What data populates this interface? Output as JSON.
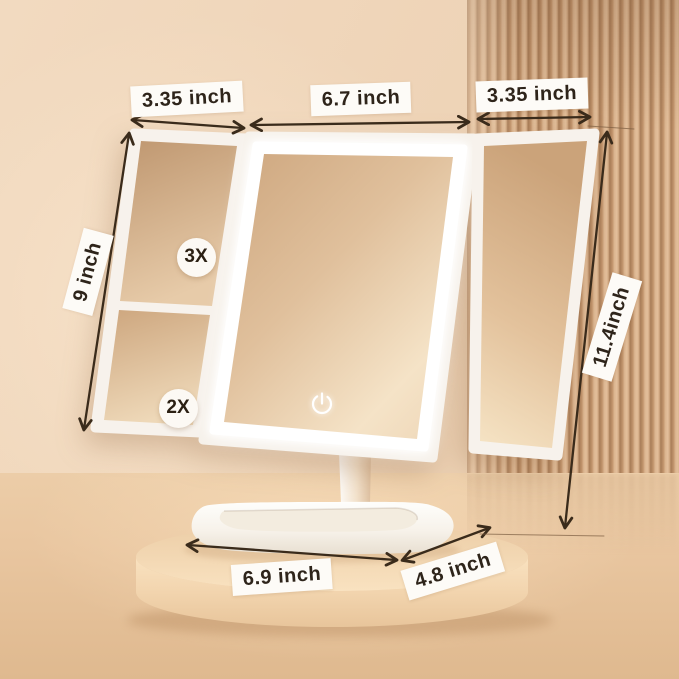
{
  "product": {
    "type": "trifold-led-vanity-mirror",
    "power_icon": "power-touch-icon"
  },
  "labels": {
    "left_panel_width": "3.35 inch",
    "center_panel_width": "6.7 inch",
    "right_panel_width": "3.35 inch",
    "side_panel_height": "9 inch",
    "overall_height": "11.4inch",
    "base_width": "6.9 inch",
    "base_depth": "4.8 inch"
  },
  "badges": {
    "magnification_top": "3X",
    "magnification_bottom": "2X"
  },
  "colors": {
    "wall": "#eed3b6",
    "floor": "#e6c29c",
    "slat_light": "#dcb691",
    "slat_dark": "#a87d58",
    "frame_white": "#ffffff",
    "glass_tint": "#e0c09c",
    "arrow": "#3a2b1b",
    "label_bg": "#fdfbf7",
    "label_text": "#2e241a"
  }
}
